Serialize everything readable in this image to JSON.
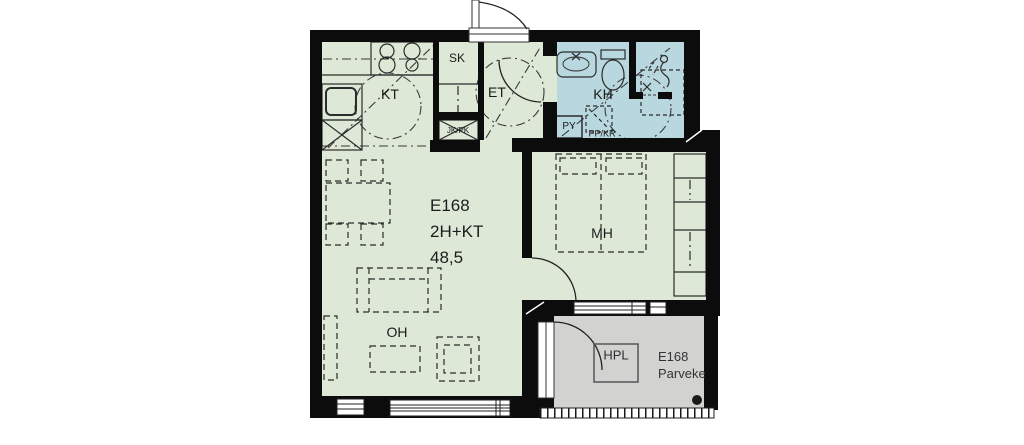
{
  "apartment": {
    "id": "E168",
    "layout": "2H+KT",
    "area": "48,5"
  },
  "rooms": {
    "kitchen": "KT",
    "cleaning_closet": "SK",
    "hall": "ET",
    "bathroom": "KH",
    "bedroom": "MH",
    "living_room": "OH"
  },
  "balcony": {
    "id": "E168",
    "name": "Parveke",
    "hpl": "HPL"
  },
  "appliance_labels": {
    "fridge_freezer": "JK/PK",
    "washing_machine": "PY",
    "dryer_reservation": "PP/KR"
  },
  "colors": {
    "floor": "#dde8d6",
    "bathroom": "#b9d7de",
    "balcony": "#d2d3d0",
    "wall": "#0c0c0c",
    "line": "#2b2b2b"
  },
  "icons": [
    "stove-icon",
    "sink-icon",
    "dishwasher-icon",
    "fridge-freezer-icon",
    "washbasin-icon",
    "toilet-icon",
    "shower-icon",
    "floor-drain-icon",
    "bed-icon",
    "wardrobe-icon",
    "dining-table-icon",
    "chair-icon",
    "sofa-icon",
    "coffee-table-icon",
    "armchair-icon",
    "door-swing-icon",
    "window-icon",
    "turning-circle-icon",
    "balcony-railing-icon",
    "drain-dot-icon"
  ]
}
